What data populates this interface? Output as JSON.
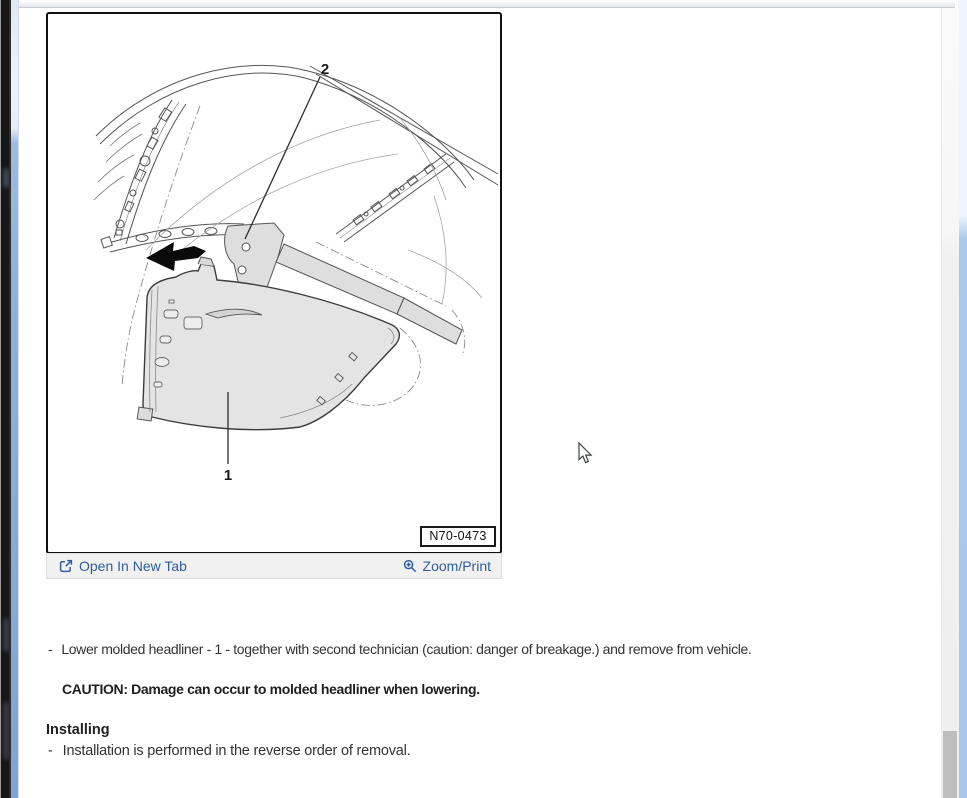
{
  "theme": {
    "link_color": "#2e5da0",
    "figure_fill": "#e4e4e4",
    "line_color": "#4a4a4a",
    "scrollbar_thumb": "#bdbdbd",
    "edge_blue": "#86abd9"
  },
  "figure": {
    "part_label_1": "1",
    "part_label_2": "2",
    "figure_number": "N70-0473"
  },
  "figure_toolbar": {
    "open_in_new_tab_label": "Open In New Tab",
    "open_in_new_tab_icon": "open-in-new-tab",
    "zoom_print_label": "Zoom/Print",
    "zoom_print_icon": "magnifier-plus"
  },
  "instructions": {
    "bullet_dash": "-",
    "step_remove": "Lower molded headliner - 1 - together with second technician (caution: danger of breakage.) and remove from vehicle.",
    "caution": "CAUTION: Damage can occur to molded headliner when lowering.",
    "installing_heading": "Installing",
    "step_install": "Installation is performed in the reverse order of removal."
  }
}
